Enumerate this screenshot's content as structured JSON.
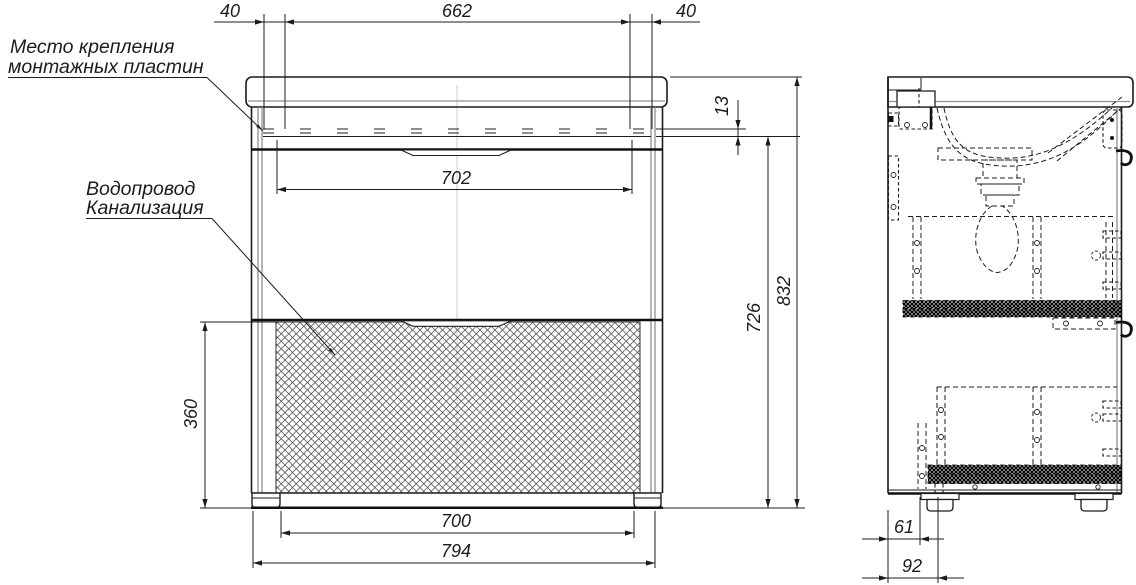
{
  "labels": {
    "mounting_plates_line1": "Место крепления",
    "mounting_plates_line2": "монтажных пластин",
    "utilities_line1": "Водопровод",
    "utilities_line2": "Канализация"
  },
  "dimensions": {
    "top_offset_left": "40",
    "top_span": "662",
    "top_offset_right": "40",
    "countertop_to_mount": "13",
    "inner_width": "702",
    "mount_height": "726",
    "total_height": "832",
    "service_zone_height": "360",
    "bottom_inner_width": "700",
    "total_width": "794",
    "foot_back_offset": "61",
    "foot_front_offset": "92"
  },
  "colors": {
    "line": "#1c1c1c",
    "panel_gray": "#8f8f8f",
    "background": "#ffffff"
  }
}
